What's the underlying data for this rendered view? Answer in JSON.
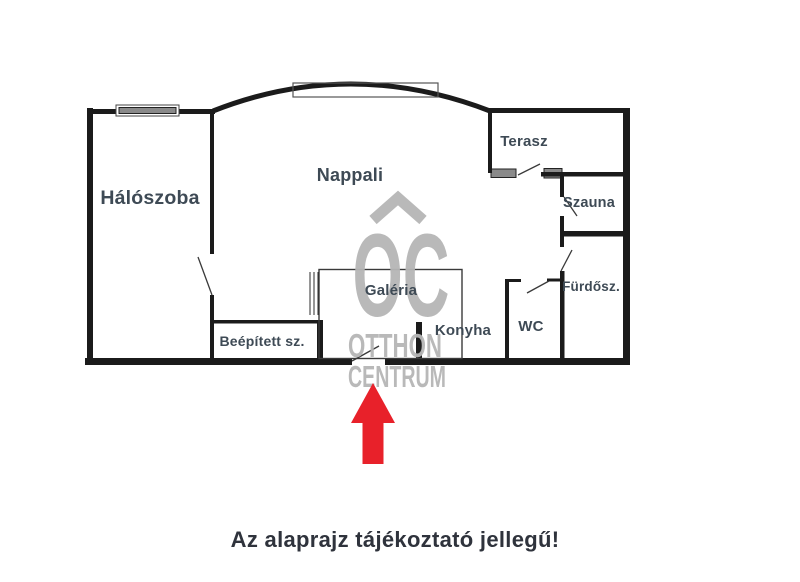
{
  "floorplan": {
    "rooms": [
      {
        "id": "haloszoba",
        "label": "Hálószoba"
      },
      {
        "id": "nappali",
        "label": "Nappali"
      },
      {
        "id": "terasz",
        "label": "Terasz"
      },
      {
        "id": "szauna",
        "label": "Szauna"
      },
      {
        "id": "furdoszoba",
        "label": "Fürdősz."
      },
      {
        "id": "wc",
        "label": "WC"
      },
      {
        "id": "konyha",
        "label": "Konyha"
      },
      {
        "id": "galeria",
        "label": "Galéria"
      },
      {
        "id": "beepitett",
        "label": "Beépített sz."
      }
    ],
    "colors": {
      "wall": "#1b1b1b",
      "window_fill": "#8a8a8a",
      "room_label": "#3e4a55",
      "watermark": "#b6b6b6",
      "arrow": "#e8212a",
      "disclaimer_text": "#2f333c"
    }
  },
  "watermark": {
    "symbol": "roof-chevron",
    "line1": "OC",
    "line2": "OTTHON",
    "line3": "CENTRUM"
  },
  "annotations": {
    "entrance_arrow_direction": "up",
    "disclaimer": "Az alaprajz tájékoztató jellegű!"
  }
}
